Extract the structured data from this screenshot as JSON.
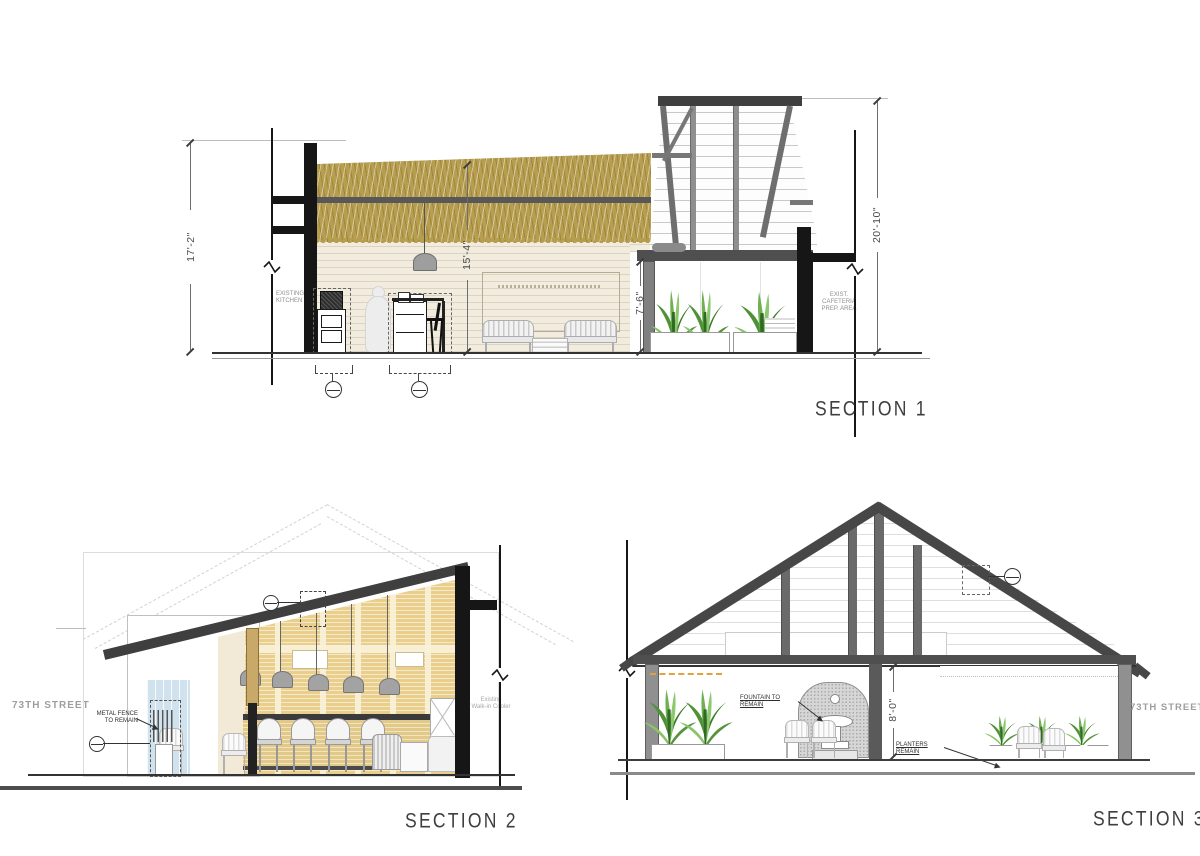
{
  "section1": {
    "title": "SECTION 1",
    "dim_left": "17'-2\"",
    "dim_interior": "15'-4\"",
    "dim_porch": "7'-6\"",
    "dim_right": "20'-10\"",
    "label_kitchen": "EXISTING\nKITCHEN",
    "label_cafeteria": "EXIST.\nCAFETERIA\nPREP. AREA"
  },
  "section2": {
    "title": "SECTION 2",
    "street": "73TH STREET",
    "label_fence": "METAL FENCE\nTO REMAIN",
    "label_cooler": "Existing\nWalk-in Cooler"
  },
  "section3": {
    "title": "SECTION 3",
    "street": "73TH STREET",
    "label_fountain": "FOUNTAIN TO REMAIN",
    "label_planters": "PLANTERS REMAIN",
    "dim_ceiling": "8'-0\""
  },
  "colors": {
    "roof_thatch": "#b79d4e",
    "structure_gray": "#4a4a4a",
    "cut_black": "#161616",
    "wall_beige": "#f2ecdf",
    "brick_tan": "#e9cf8b",
    "glass_blue": "#cfe2ed",
    "plant_green": "#5a9e3c"
  }
}
